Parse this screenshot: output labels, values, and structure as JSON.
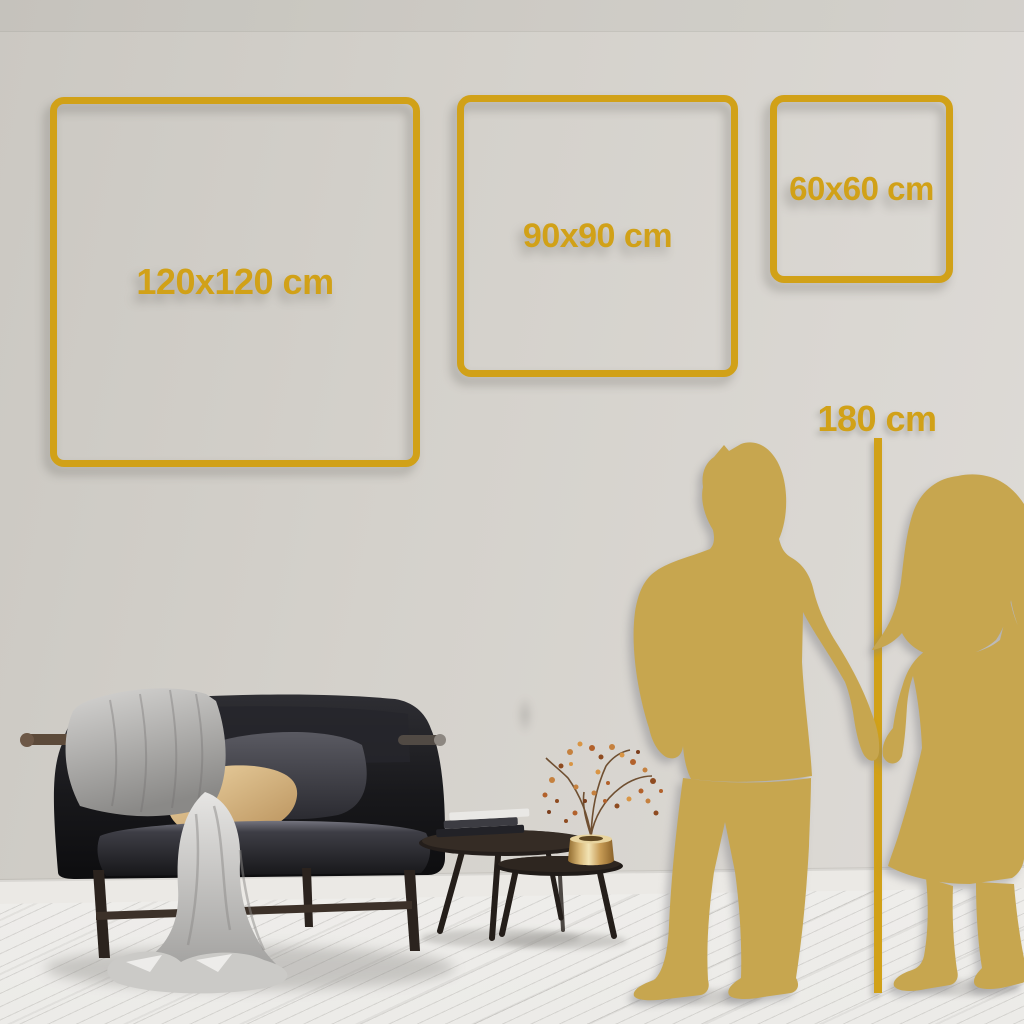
{
  "size_guide": {
    "frames": [
      {
        "label": "120x120 cm"
      },
      {
        "label": "90x90 cm"
      },
      {
        "label": "60x60 cm"
      }
    ],
    "height_reference": {
      "label": "180 cm"
    }
  },
  "colors": {
    "accent_gold": "#D1A118",
    "silhouette_gold": "#C7A64F",
    "wall": "#D4D1CB",
    "baseboard": "#EBE9E5",
    "floor": "#F3F2EF"
  },
  "scene_elements": [
    "man-silhouette",
    "woman-silhouette",
    "sofa",
    "throw-blanket",
    "dark-pillow",
    "tan-pillow",
    "nesting-coffee-tables",
    "books-stack",
    "brass-vase",
    "dried-branch"
  ]
}
